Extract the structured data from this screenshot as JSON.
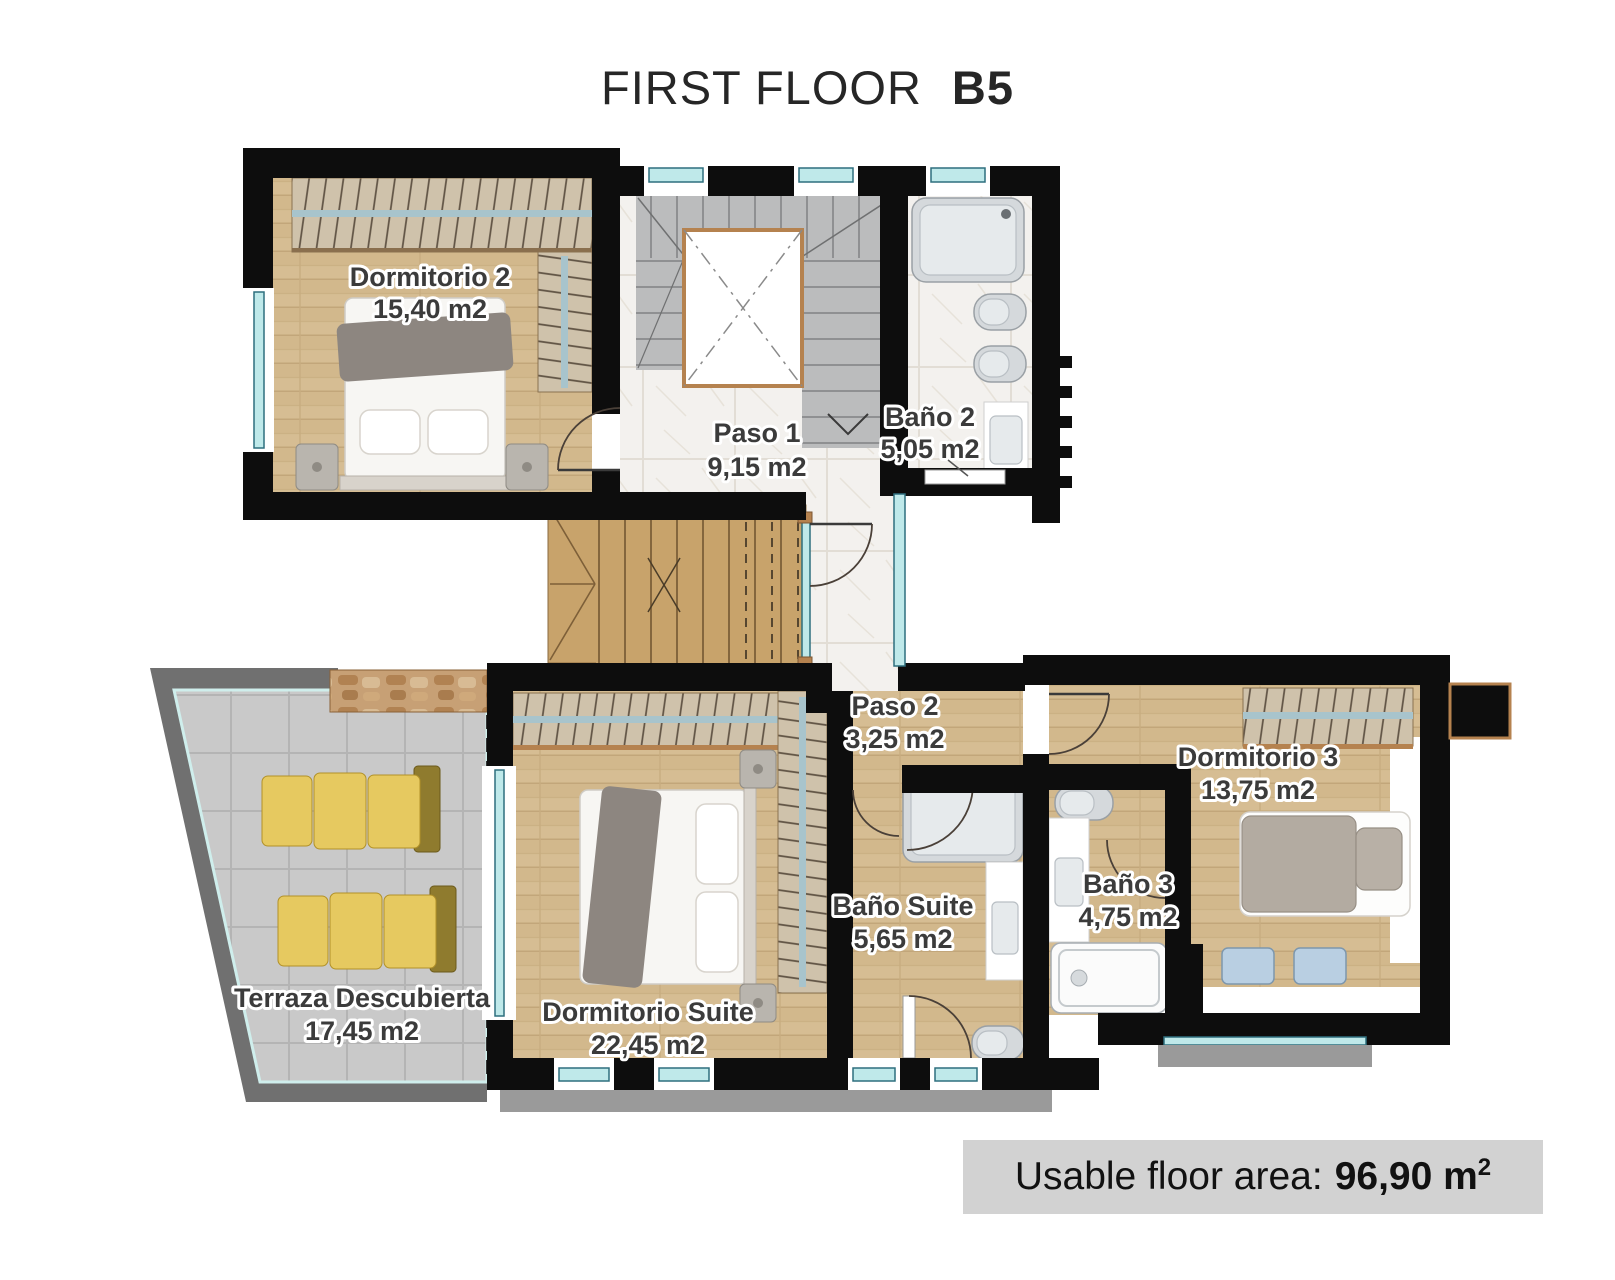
{
  "title": {
    "main": "FIRST FLOOR",
    "unit": "B5"
  },
  "rooms": {
    "dormitorio2": {
      "name": "Dormitorio 2",
      "area": "15,40 m2"
    },
    "paso1": {
      "name": "Paso 1",
      "area": "9,15 m2"
    },
    "bano2": {
      "name": "Baño 2",
      "area": "5,05 m2"
    },
    "paso2": {
      "name": "Paso 2",
      "area": "3,25 m2"
    },
    "dormitorio3": {
      "name": "Dormitorio 3",
      "area": "13,75 m2"
    },
    "bano_suite": {
      "name": "Baño Suite",
      "area": "5,65 m2"
    },
    "bano3": {
      "name": "Baño 3",
      "area": "4,75 m2"
    },
    "dormitorio_suite": {
      "name": "Dormitorio Suite",
      "area": "22,45 m2"
    },
    "terraza": {
      "name": "Terraza Descubierta",
      "area": "17,45 m2"
    }
  },
  "footer": {
    "label": "Usable floor area:",
    "value": "96,90 m",
    "sup": "2"
  },
  "colors": {
    "wall": "#0d0d0d",
    "wood": "#d6bd93",
    "marble": "#f3f1ed",
    "terrace_tile": "#c9c9c9",
    "terrace_band": "#707070",
    "accent_teal": "#bfe9ea",
    "accent_orange": "#b5824f",
    "lounger_yellow": "#e6c960",
    "fixture_gray": "#d5d9dc",
    "footer_bg": "#d2d2d2",
    "label_text": "#3b3b3b"
  }
}
